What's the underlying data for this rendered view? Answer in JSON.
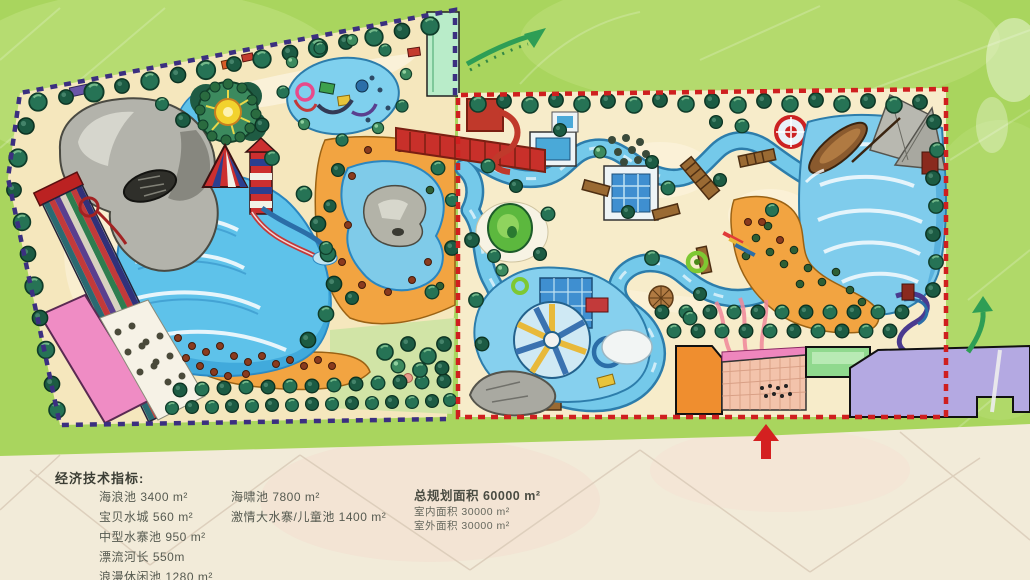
{
  "indicators": {
    "heading": "经济技术指标:",
    "left_column": [
      "海浪池 3400 m²",
      "宝贝水城 560 m²",
      "中型水寨池 950 m²",
      "漂流河长 550m",
      "浪漫休闲池 1280 m²"
    ],
    "middle_column": [
      "海啸池 7800 m²",
      "激情大水寨/儿童池 1400 m²"
    ],
    "totals": {
      "title": "总规划面积 60000 m²",
      "details": [
        "室内面积 30000 m²",
        "室外面积 30000 m²"
      ]
    }
  },
  "icons": {
    "entrance_arrow": "red-up-arrow-icon",
    "flow_arrow_top": "green-curved-arrow-icon",
    "flow_arrow_right": "green-curved-arrow-icon"
  },
  "colors": {
    "field_green": "#a9d55e",
    "paper_cream": "#f2ebd9",
    "sand": "#f5e7bd",
    "water_blue": "#6fc7e9",
    "beach_orange": "#f2a441",
    "west_boundary_navy": "#3b2f80",
    "east_boundary_red": "#cf1f1f",
    "tree_green": "#267355",
    "entrance_red": "#d42020"
  }
}
